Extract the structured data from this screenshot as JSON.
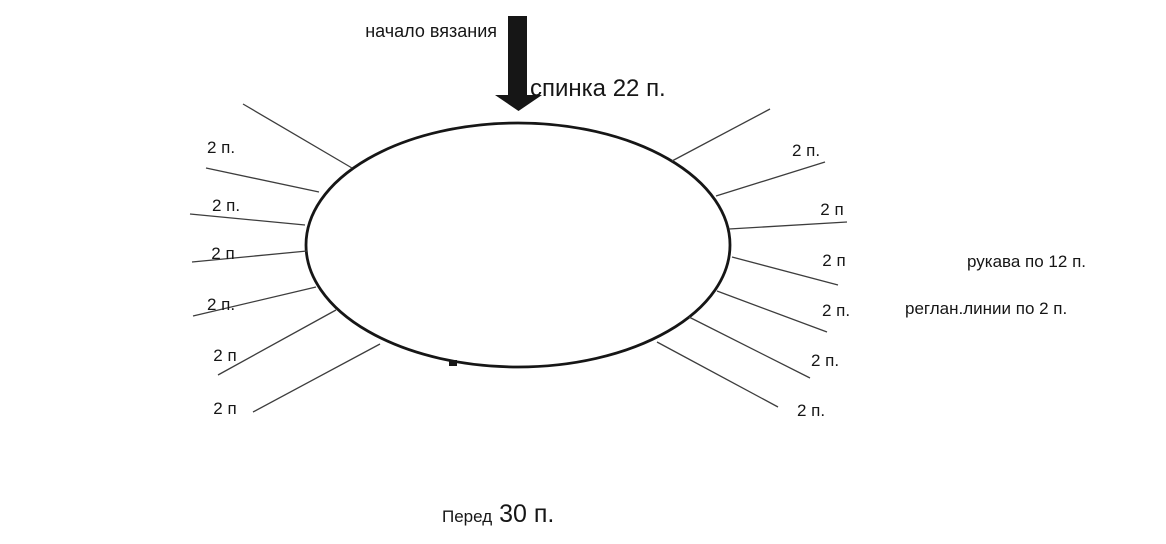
{
  "colors": {
    "ink": "#161616",
    "line": "#3d3d3d",
    "background": "#ffffff"
  },
  "labels": {
    "start": "начало вязания",
    "back": "спинка 22 п.",
    "front_word": "Перед",
    "front_count": "30 п.",
    "sleeves_note": "рукава по 12 п.",
    "raglan_note": "реглан.линии по 2 п."
  },
  "diagram": {
    "ellipse": {
      "cx": 518,
      "cy": 245,
      "rx": 212,
      "ry": 122
    },
    "arrow_points": "508,16 527,16 527,95 542,95 518.5,111 495,95 508,95",
    "cast_on_mark": {
      "x": 449,
      "y": 360,
      "width": 8,
      "height": 6
    },
    "lines": [
      {
        "x1": 243,
        "y1": 104,
        "x2": 352,
        "y2": 168
      },
      {
        "x1": 206,
        "y1": 168,
        "x2": 319,
        "y2": 192
      },
      {
        "x1": 190,
        "y1": 214,
        "x2": 305,
        "y2": 225
      },
      {
        "x1": 192,
        "y1": 262,
        "x2": 307,
        "y2": 251
      },
      {
        "x1": 193,
        "y1": 316,
        "x2": 316,
        "y2": 287
      },
      {
        "x1": 218,
        "y1": 375,
        "x2": 336,
        "y2": 310
      },
      {
        "x1": 253,
        "y1": 412,
        "x2": 380,
        "y2": 344
      },
      {
        "x1": 770,
        "y1": 109,
        "x2": 672,
        "y2": 161
      },
      {
        "x1": 825,
        "y1": 162,
        "x2": 716,
        "y2": 196
      },
      {
        "x1": 847,
        "y1": 222,
        "x2": 729,
        "y2": 229
      },
      {
        "x1": 838,
        "y1": 285,
        "x2": 732,
        "y2": 257
      },
      {
        "x1": 827,
        "y1": 332,
        "x2": 717,
        "y2": 291
      },
      {
        "x1": 810,
        "y1": 378,
        "x2": 689,
        "y2": 317
      },
      {
        "x1": 778,
        "y1": 407,
        "x2": 657,
        "y2": 342
      }
    ],
    "stitch_labels": [
      {
        "text": "2 п.",
        "x": 221,
        "y": 148
      },
      {
        "text": "2 п.",
        "x": 226,
        "y": 206
      },
      {
        "text": "2 п",
        "x": 223,
        "y": 254
      },
      {
        "text": "2 п.",
        "x": 221,
        "y": 305
      },
      {
        "text": "2 п",
        "x": 225,
        "y": 356
      },
      {
        "text": "2 п",
        "x": 225,
        "y": 409
      },
      {
        "text": "2 п.",
        "x": 806,
        "y": 151
      },
      {
        "text": "2 п",
        "x": 832,
        "y": 210
      },
      {
        "text": "2 п",
        "x": 834,
        "y": 261
      },
      {
        "text": "2 п.",
        "x": 836,
        "y": 311
      },
      {
        "text": "2 п.",
        "x": 825,
        "y": 361
      },
      {
        "text": "2 п.",
        "x": 811,
        "y": 411
      }
    ]
  }
}
